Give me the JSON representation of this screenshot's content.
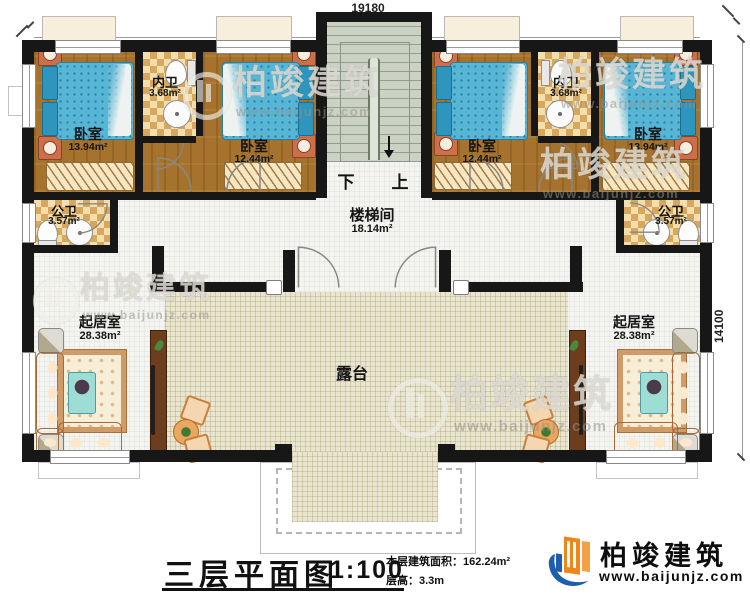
{
  "dimensions": {
    "top_width": "19180",
    "right_height": "14100"
  },
  "rooms": {
    "bedroom_tl": {
      "name": "卧室",
      "area": "13.94m²"
    },
    "inner_bath_l": {
      "name": "内卫",
      "area": "3.68m²"
    },
    "bedroom_ml": {
      "name": "卧室",
      "area": "12.44m²"
    },
    "bedroom_mr": {
      "name": "卧室",
      "area": "12.44m²"
    },
    "inner_bath_r": {
      "name": "内卫",
      "area": "3.68m²"
    },
    "bedroom_tr": {
      "name": "卧室",
      "area": "13.94m²"
    },
    "public_bath_l": {
      "name": "公卫",
      "area": "3.57m²"
    },
    "public_bath_r": {
      "name": "公卫",
      "area": "3.57m²"
    },
    "stair_hall": {
      "name": "楼梯间",
      "area": "18.14m²"
    },
    "living_l": {
      "name": "起居室",
      "area": "28.38m²"
    },
    "living_r": {
      "name": "起居室",
      "area": "28.38m²"
    },
    "terrace": {
      "name": "露台"
    }
  },
  "stairs": {
    "down_label": "下",
    "up_label": "上"
  },
  "title_block": {
    "title": "三层平面图",
    "scale": "1:100",
    "floor_area": "本层建筑面积：162.24m²",
    "floor_height": "层高：3.3m"
  },
  "brand": {
    "name": "柏竣建筑",
    "website": "www.baijunjz.com"
  },
  "watermark": {
    "name": "柏竣建筑",
    "website": "www.baijunjz.com"
  },
  "colors": {
    "brand_blue": "#1d5fae",
    "brand_orange": "#f08519",
    "wall": "#171717",
    "bed": "#57b5d5"
  }
}
